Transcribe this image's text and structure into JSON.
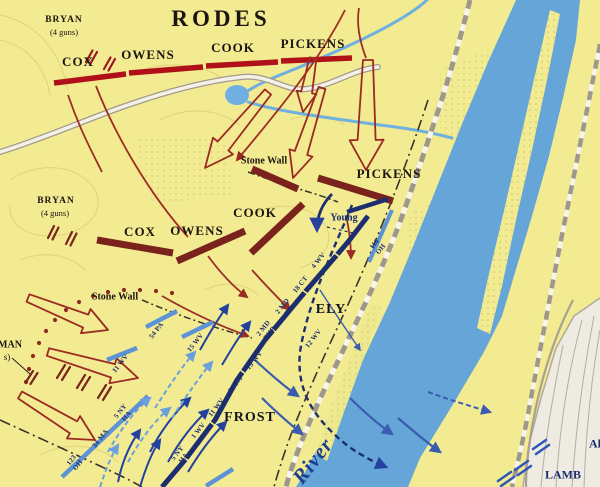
{
  "title": "RODES",
  "confederate": {
    "bryan_top": {
      "name": "BRYAN",
      "guns": "(4 guns)"
    },
    "bryan_mid": {
      "name": "BRYAN",
      "guns": "(4 guns)"
    },
    "line1": {
      "cox": "COX",
      "owens": "OWENS",
      "cook": "COOK",
      "pickens": "PICKENS"
    },
    "line2": {
      "cox": "COX",
      "owens": "OWENS",
      "cook": "COOK",
      "pickens": "PICKENS"
    },
    "edge_fragment": {
      "line1": "MAN",
      "line2": "s)"
    }
  },
  "union": {
    "ely": "ELY",
    "frost": "FROST",
    "young": "Young",
    "lamb": "LAMB",
    "edge_fragment": "Al",
    "main_line_regiments": [
      {
        "lines": [
          "5 NY",
          "HA"
        ]
      },
      {
        "lines": [
          "1 WV"
        ]
      },
      {
        "lines": [
          "11 WV"
        ]
      },
      {
        "lines": [
          "54 PA"
        ]
      },
      {
        "lines": [
          "15 WV"
        ]
      },
      {
        "lines": [
          "2 MD",
          "PHB"
        ]
      },
      {
        "lines": [
          "2 MD",
          "ES"
        ]
      },
      {
        "lines": [
          "18 CT"
        ]
      },
      {
        "lines": [
          "4 WV"
        ]
      },
      {
        "lines": [
          "12 WV"
        ]
      },
      {
        "lines": [
          "116",
          "OH"
        ]
      }
    ],
    "first_position_regiments": [
      {
        "lines": [
          "123",
          "OH"
        ]
      },
      {
        "lines": [
          "34 MA"
        ]
      },
      {
        "lines": [
          "5 NY",
          "HA"
        ]
      },
      {
        "lines": [
          "11 WV"
        ]
      },
      {
        "lines": [
          "54 PA"
        ]
      },
      {
        "lines": [
          "15 WV"
        ]
      }
    ]
  },
  "terrain": {
    "stone_wall_upper": "Stone Wall",
    "stone_wall_lower": "Stone Wall",
    "river": "River"
  },
  "colors": {
    "background_yellow": "#f2eb92",
    "river_blue": "#66a5d8",
    "confederate_red": "#b01018",
    "confederate_maroon": "#7a231c",
    "union_navy": "#1d2e6e",
    "union_light_blue": "#5d93d6"
  }
}
